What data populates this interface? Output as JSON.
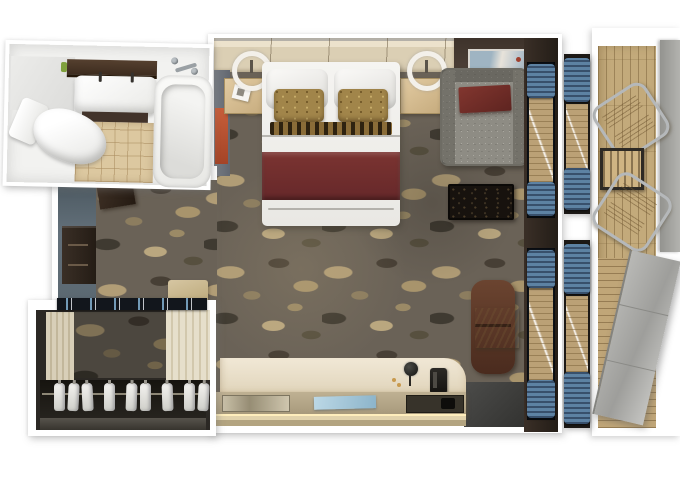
{
  "scene": {
    "type": "floor-plan-render",
    "description": "3D top-down rendering of a suite / stateroom floor plan with balcony",
    "rooms": [
      {
        "name": "bathroom",
        "furniture": [
          "vanity-shelf",
          "double-sink",
          "under-cabinet",
          "bathtub",
          "tub-faucet",
          "toilet",
          "tile-floor"
        ]
      },
      {
        "name": "entry-corridor",
        "furniture": [
          "entry-door",
          "minibar-cabinet",
          "bench",
          "bottle-shelf"
        ]
      },
      {
        "name": "wardrobe",
        "furniture": [
          "clothes-rail",
          "hanging-shirts"
        ],
        "shirt_count": 9
      },
      {
        "name": "bedroom",
        "furniture": [
          "headboard",
          "double-bed",
          "white-pillows",
          "gold-accent-pillows",
          "maroon-bed-runner",
          "nightstand-left",
          "nightstand-right",
          "ring-lamp-left",
          "ring-lamp-right",
          "wall-art",
          "orange-wall-art",
          "sofa",
          "maroon-throw",
          "carved-black-table",
          "lounge-chair",
          "side-table",
          "desk-counter",
          "desk-lamp",
          "telephone",
          "blue-folder",
          "metal-tray",
          "dark-tray"
        ]
      },
      {
        "name": "balcony",
        "furniture": [
          "deck-chair-top",
          "deck-chair-bottom",
          "slatted-table",
          "privacy-divider",
          "divider-door"
        ],
        "chair_count": 2
      }
    ],
    "window_strips": 2
  },
  "palette": {
    "background": "#ffffff",
    "carpet_base": "#6a6257",
    "carpet_tan": "#b19d76",
    "carpet_dark": "#3f3a31",
    "headboard_wood": "#dbcfb4",
    "nightstand_wood": "#d3b88c",
    "bed_white": "#f2f1ee",
    "bed_maroon": "#702e2d",
    "pillow_gold": "#a1854a",
    "sofa_gray": "#8e8c84",
    "sofa_throw_maroon": "#7a3231",
    "wall_dark_brown": "#3a2f27",
    "wall_gray": "#6e737a",
    "art_orange": "#bf5a38",
    "desk_cream": "#e9e0cf",
    "desk_glow": "#ffe6a6",
    "folder_blue": "#a6c8da",
    "curtain_blue": "#5d82a3",
    "deck_wood": "#c3aa7b",
    "divider_gray": "#9e9e9b",
    "closet_interior": "#2b2824",
    "shirt_white": "#eceae6",
    "corridor_wall_blue": "#5e6a73",
    "cabinet_brown": "#332a23",
    "bath_floor_tile": "#dcc8a0",
    "bath_shelf_brown": "#4c3a2c",
    "fixture_white": "#f7f7f5"
  }
}
